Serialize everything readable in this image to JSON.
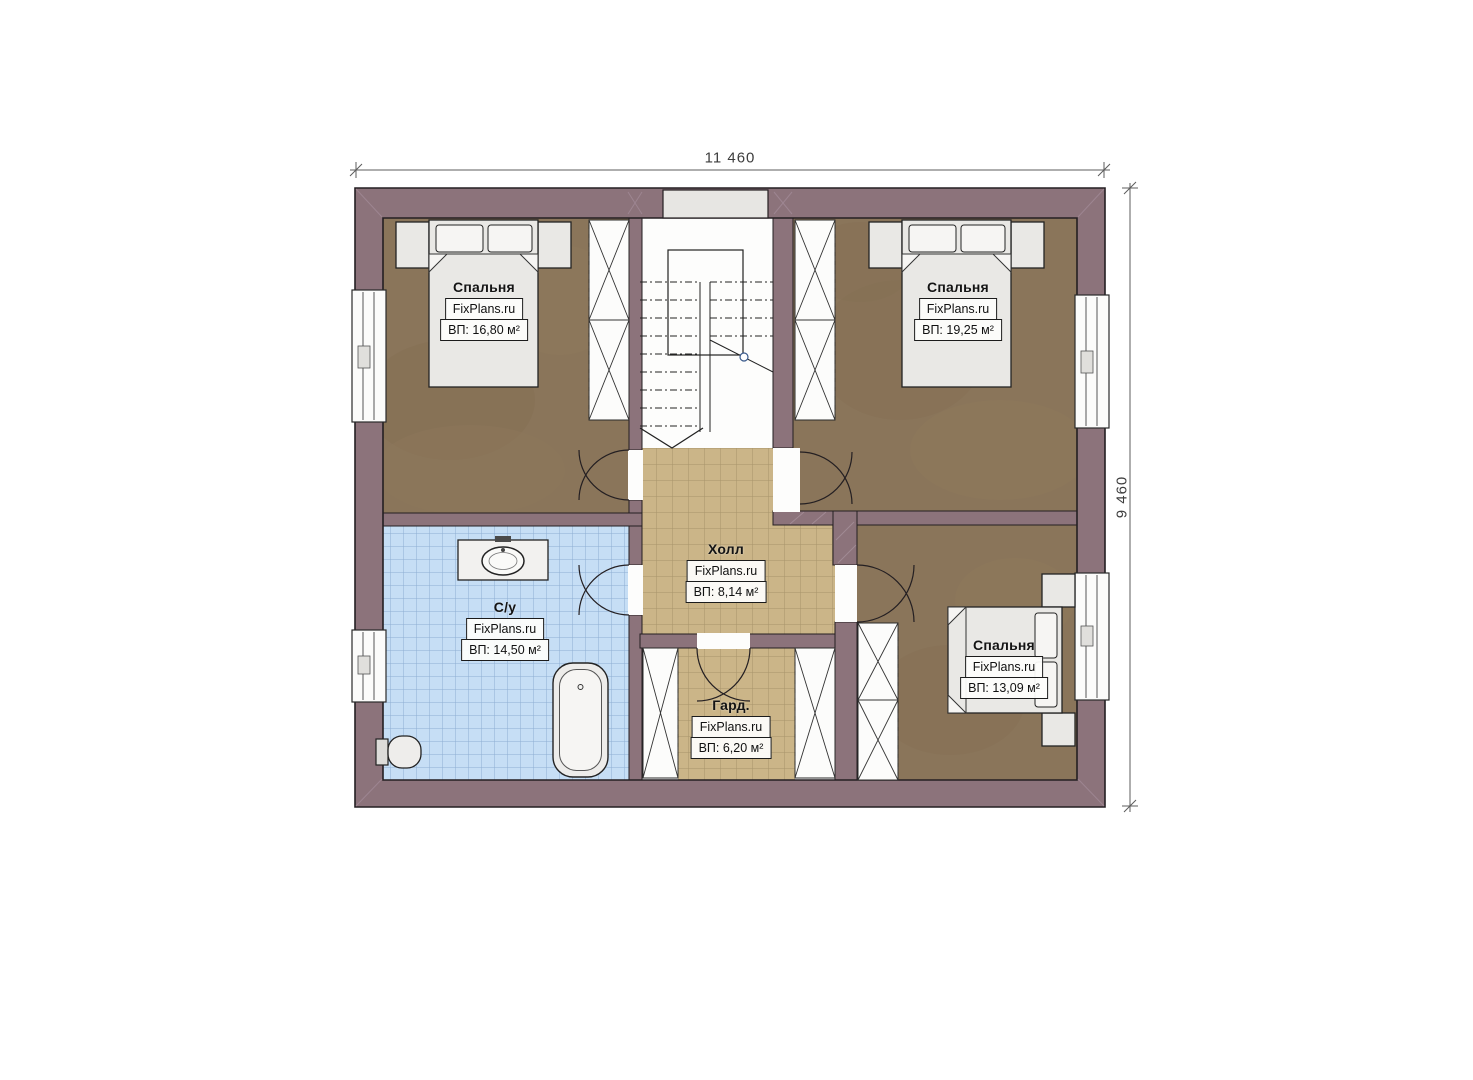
{
  "brand": "FixPlans.ru",
  "dimensions": {
    "width": "11 460",
    "height": "9 460"
  },
  "rooms": [
    {
      "id": "bedroom-top-left",
      "name": "Спальня",
      "area": "ВП: 16,80 м²"
    },
    {
      "id": "bedroom-top-right",
      "name": "Спальня",
      "area": "ВП: 19,25 м²"
    },
    {
      "id": "hall",
      "name": "Холл",
      "area": "ВП: 8,14 м²"
    },
    {
      "id": "bathroom",
      "name": "С/у",
      "area": "ВП: 14,50 м²"
    },
    {
      "id": "wardrobe-room",
      "name": "Гард.",
      "area": "ВП: 6,20 м²"
    },
    {
      "id": "bedroom-bottom-right",
      "name": "Спальня",
      "area": "ВП: 13,09 м²"
    }
  ],
  "colors": {
    "wall": "#8c737b",
    "bedroom_floor": "#8a755a",
    "tile_tan": "#cbb588",
    "tile_blue": "#c6def5",
    "furniture": "#e9e8e5",
    "background": "#ffffff"
  }
}
